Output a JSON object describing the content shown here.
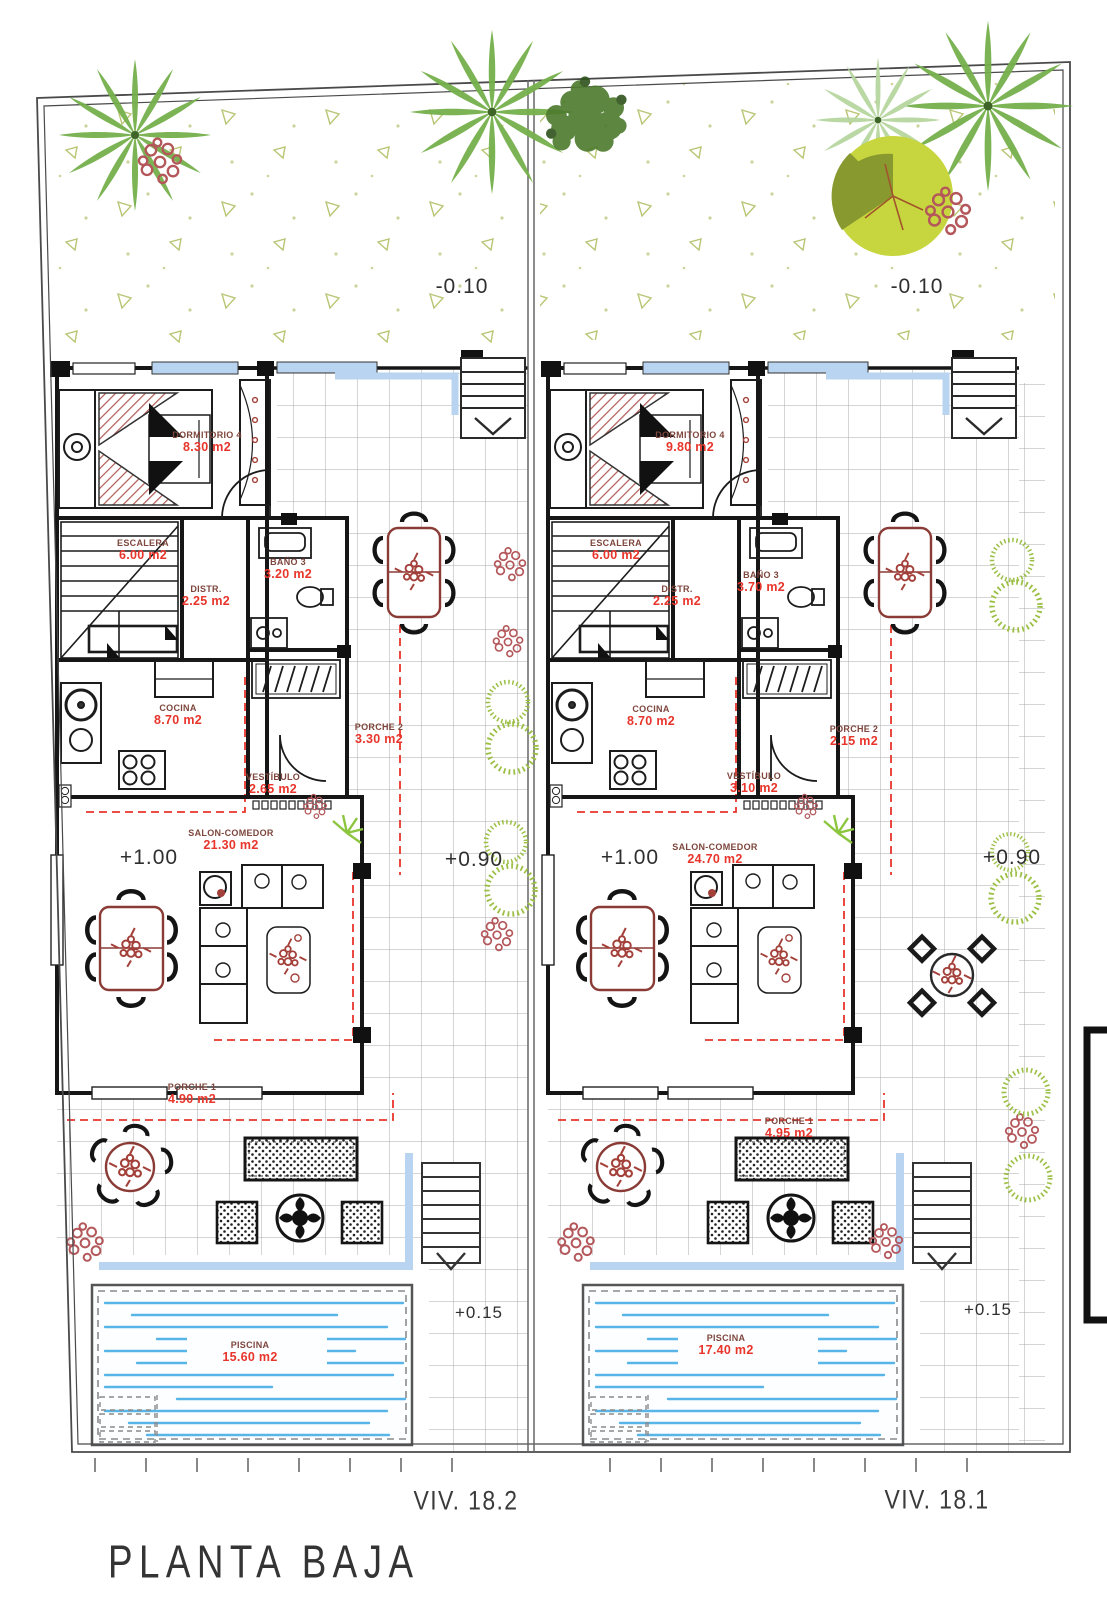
{
  "plan": {
    "title": "PLANTA BAJA",
    "drawing_type": "ground-floor-plan",
    "units": [
      {
        "name": "VIV. 18.2",
        "levels": {
          "garden": "-0.10",
          "salon": "+1.00",
          "terrace": "+0.90",
          "pool_deck": "+0.15"
        },
        "rooms": [
          {
            "name": "DORMITORIO 4",
            "area": "8.30 m2"
          },
          {
            "name": "ESCALERA",
            "area": "6.00 m2"
          },
          {
            "name": "DISTR.",
            "area": "2.25 m2"
          },
          {
            "name": "BAÑO 3",
            "area": "3.20 m2"
          },
          {
            "name": "COCINA",
            "area": "8.70 m2"
          },
          {
            "name": "PORCHE 2",
            "area": "3.30 m2"
          },
          {
            "name": "VESTÍBULO",
            "area": "2.65 m2"
          },
          {
            "name": "SALON-COMEDOR",
            "area": "21.30 m2"
          },
          {
            "name": "PORCHE 1",
            "area": "4.90 m2"
          },
          {
            "name": "PISCINA",
            "area": "15.60 m2"
          }
        ]
      },
      {
        "name": "VIV. 18.1",
        "levels": {
          "garden": "-0.10",
          "salon": "+1.00",
          "terrace": "+0.90",
          "pool_deck": "+0.15"
        },
        "rooms": [
          {
            "name": "DORMITORIO 4",
            "area": "9.80 m2"
          },
          {
            "name": "ESCALERA",
            "area": "6.00 m2"
          },
          {
            "name": "DISTR.",
            "area": "2.25 m2"
          },
          {
            "name": "BAÑO 3",
            "area": "3.70 m2"
          },
          {
            "name": "COCINA",
            "area": "8.70 m2"
          },
          {
            "name": "PORCHE 2",
            "area": "2.15 m2"
          },
          {
            "name": "VESTÍBULO",
            "area": "3.10 m2"
          },
          {
            "name": "SALON-COMEDOR",
            "area": "24.70 m2"
          },
          {
            "name": "PORCHE 1",
            "area": "4.95 m2"
          },
          {
            "name": "PISCINA",
            "area": "17.40 m2"
          }
        ]
      }
    ]
  },
  "colors": {
    "area_text": "#e8352b",
    "room_text": "#7e463d",
    "water_line": "#58b5e8",
    "window_band": "#b8d4f0",
    "palm_green": "#76b14c",
    "scatter_olive": "#b9c573",
    "flower_red": "#b4575a",
    "ring_bush_green": "#9cc045"
  }
}
